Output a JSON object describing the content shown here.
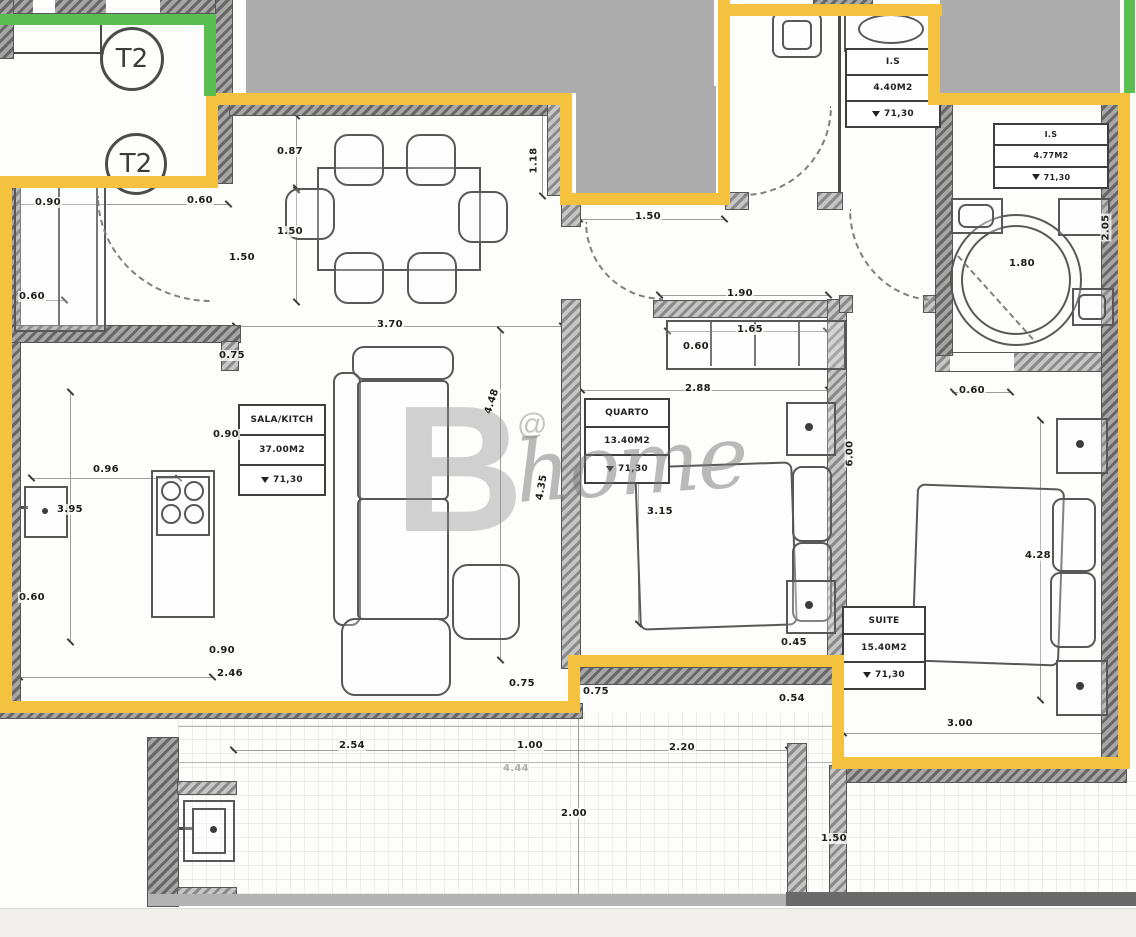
{
  "meta": {
    "drawing_type": "apartment floor plan",
    "unit_type": "T2"
  },
  "palette": {
    "highlight_yellow": "#F4C23F",
    "highlight_green": "#5ABE50",
    "redaction_gray": "#ACACAC",
    "line_dark": "#4a4a4a"
  },
  "unit_labels": [
    {
      "text": "T2"
    },
    {
      "text": "T2"
    }
  ],
  "level_marker": "▼",
  "watermark": {
    "letter": "B",
    "at": "@",
    "word": "home"
  },
  "rooms": {
    "sala": {
      "title": "SALA/KITCH",
      "area": "37.00M2",
      "level": "71,30"
    },
    "quarto": {
      "title": "QUARTO",
      "area": "13.40M2",
      "level": "71,30"
    },
    "suite": {
      "title": "SUITE",
      "area": "15.40M2",
      "level": "71,30"
    },
    "wc": {
      "title": "I.S",
      "area": "4.40M2",
      "level": "71,30"
    },
    "bathroom": {
      "title": "I.S",
      "area": "4.77M2",
      "level": "71,30"
    }
  },
  "dimensions": [
    {
      "label": "0.90",
      "x": 34,
      "y": 197
    },
    {
      "label": "0.60",
      "x": 186,
      "y": 195
    },
    {
      "label": "1.50",
      "x": 228,
      "y": 252
    },
    {
      "label": "0.60",
      "x": 18,
      "y": 291
    },
    {
      "label": "0.87",
      "x": 276,
      "y": 146
    },
    {
      "label": "1.18",
      "x": 520,
      "y": 155,
      "rot": 90
    },
    {
      "label": "1.50",
      "x": 276,
      "y": 226
    },
    {
      "label": "3.70",
      "x": 376,
      "y": 319
    },
    {
      "label": "0.75",
      "x": 218,
      "y": 350
    },
    {
      "label": "0.90",
      "x": 212,
      "y": 429
    },
    {
      "label": "0.96",
      "x": 92,
      "y": 464
    },
    {
      "label": "3.95",
      "x": 56,
      "y": 504
    },
    {
      "label": "0.60",
      "x": 18,
      "y": 592
    },
    {
      "label": "0.90",
      "x": 208,
      "y": 645
    },
    {
      "label": "2.46",
      "x": 216,
      "y": 668
    },
    {
      "label": "4.48",
      "x": 478,
      "y": 396,
      "rot": 72
    },
    {
      "label": "4.35",
      "x": 528,
      "y": 482,
      "rot": 80
    },
    {
      "label": "1.50",
      "x": 634,
      "y": 211
    },
    {
      "label": "1.90",
      "x": 726,
      "y": 288
    },
    {
      "label": "1.65",
      "x": 736,
      "y": 324
    },
    {
      "label": "0.60",
      "x": 682,
      "y": 341
    },
    {
      "label": "2.88",
      "x": 684,
      "y": 383
    },
    {
      "label": "3.15",
      "x": 646,
      "y": 506
    },
    {
      "label": "6.00",
      "x": 836,
      "y": 448,
      "rot": 90
    },
    {
      "label": "0.45",
      "x": 780,
      "y": 637
    },
    {
      "label": "0.54",
      "x": 778,
      "y": 693
    },
    {
      "label": "0.75",
      "x": 508,
      "y": 678
    },
    {
      "label": "0.75",
      "x": 582,
      "y": 686
    },
    {
      "label": "0.60",
      "x": 958,
      "y": 385
    },
    {
      "label": "1.80",
      "x": 1008,
      "y": 258
    },
    {
      "label": "2.05",
      "x": 1092,
      "y": 222,
      "rot": 90
    },
    {
      "label": "4.28",
      "x": 1024,
      "y": 550
    },
    {
      "label": "3.00",
      "x": 946,
      "y": 718
    },
    {
      "label": "2.54",
      "x": 338,
      "y": 740
    },
    {
      "label": "1.00",
      "x": 516,
      "y": 740
    },
    {
      "label": "2.20",
      "x": 668,
      "y": 742
    },
    {
      "label": "4.44",
      "x": 502,
      "y": 763,
      "faint": true
    },
    {
      "label": "2.00",
      "x": 560,
      "y": 808
    },
    {
      "label": "1.50",
      "x": 820,
      "y": 833
    }
  ]
}
